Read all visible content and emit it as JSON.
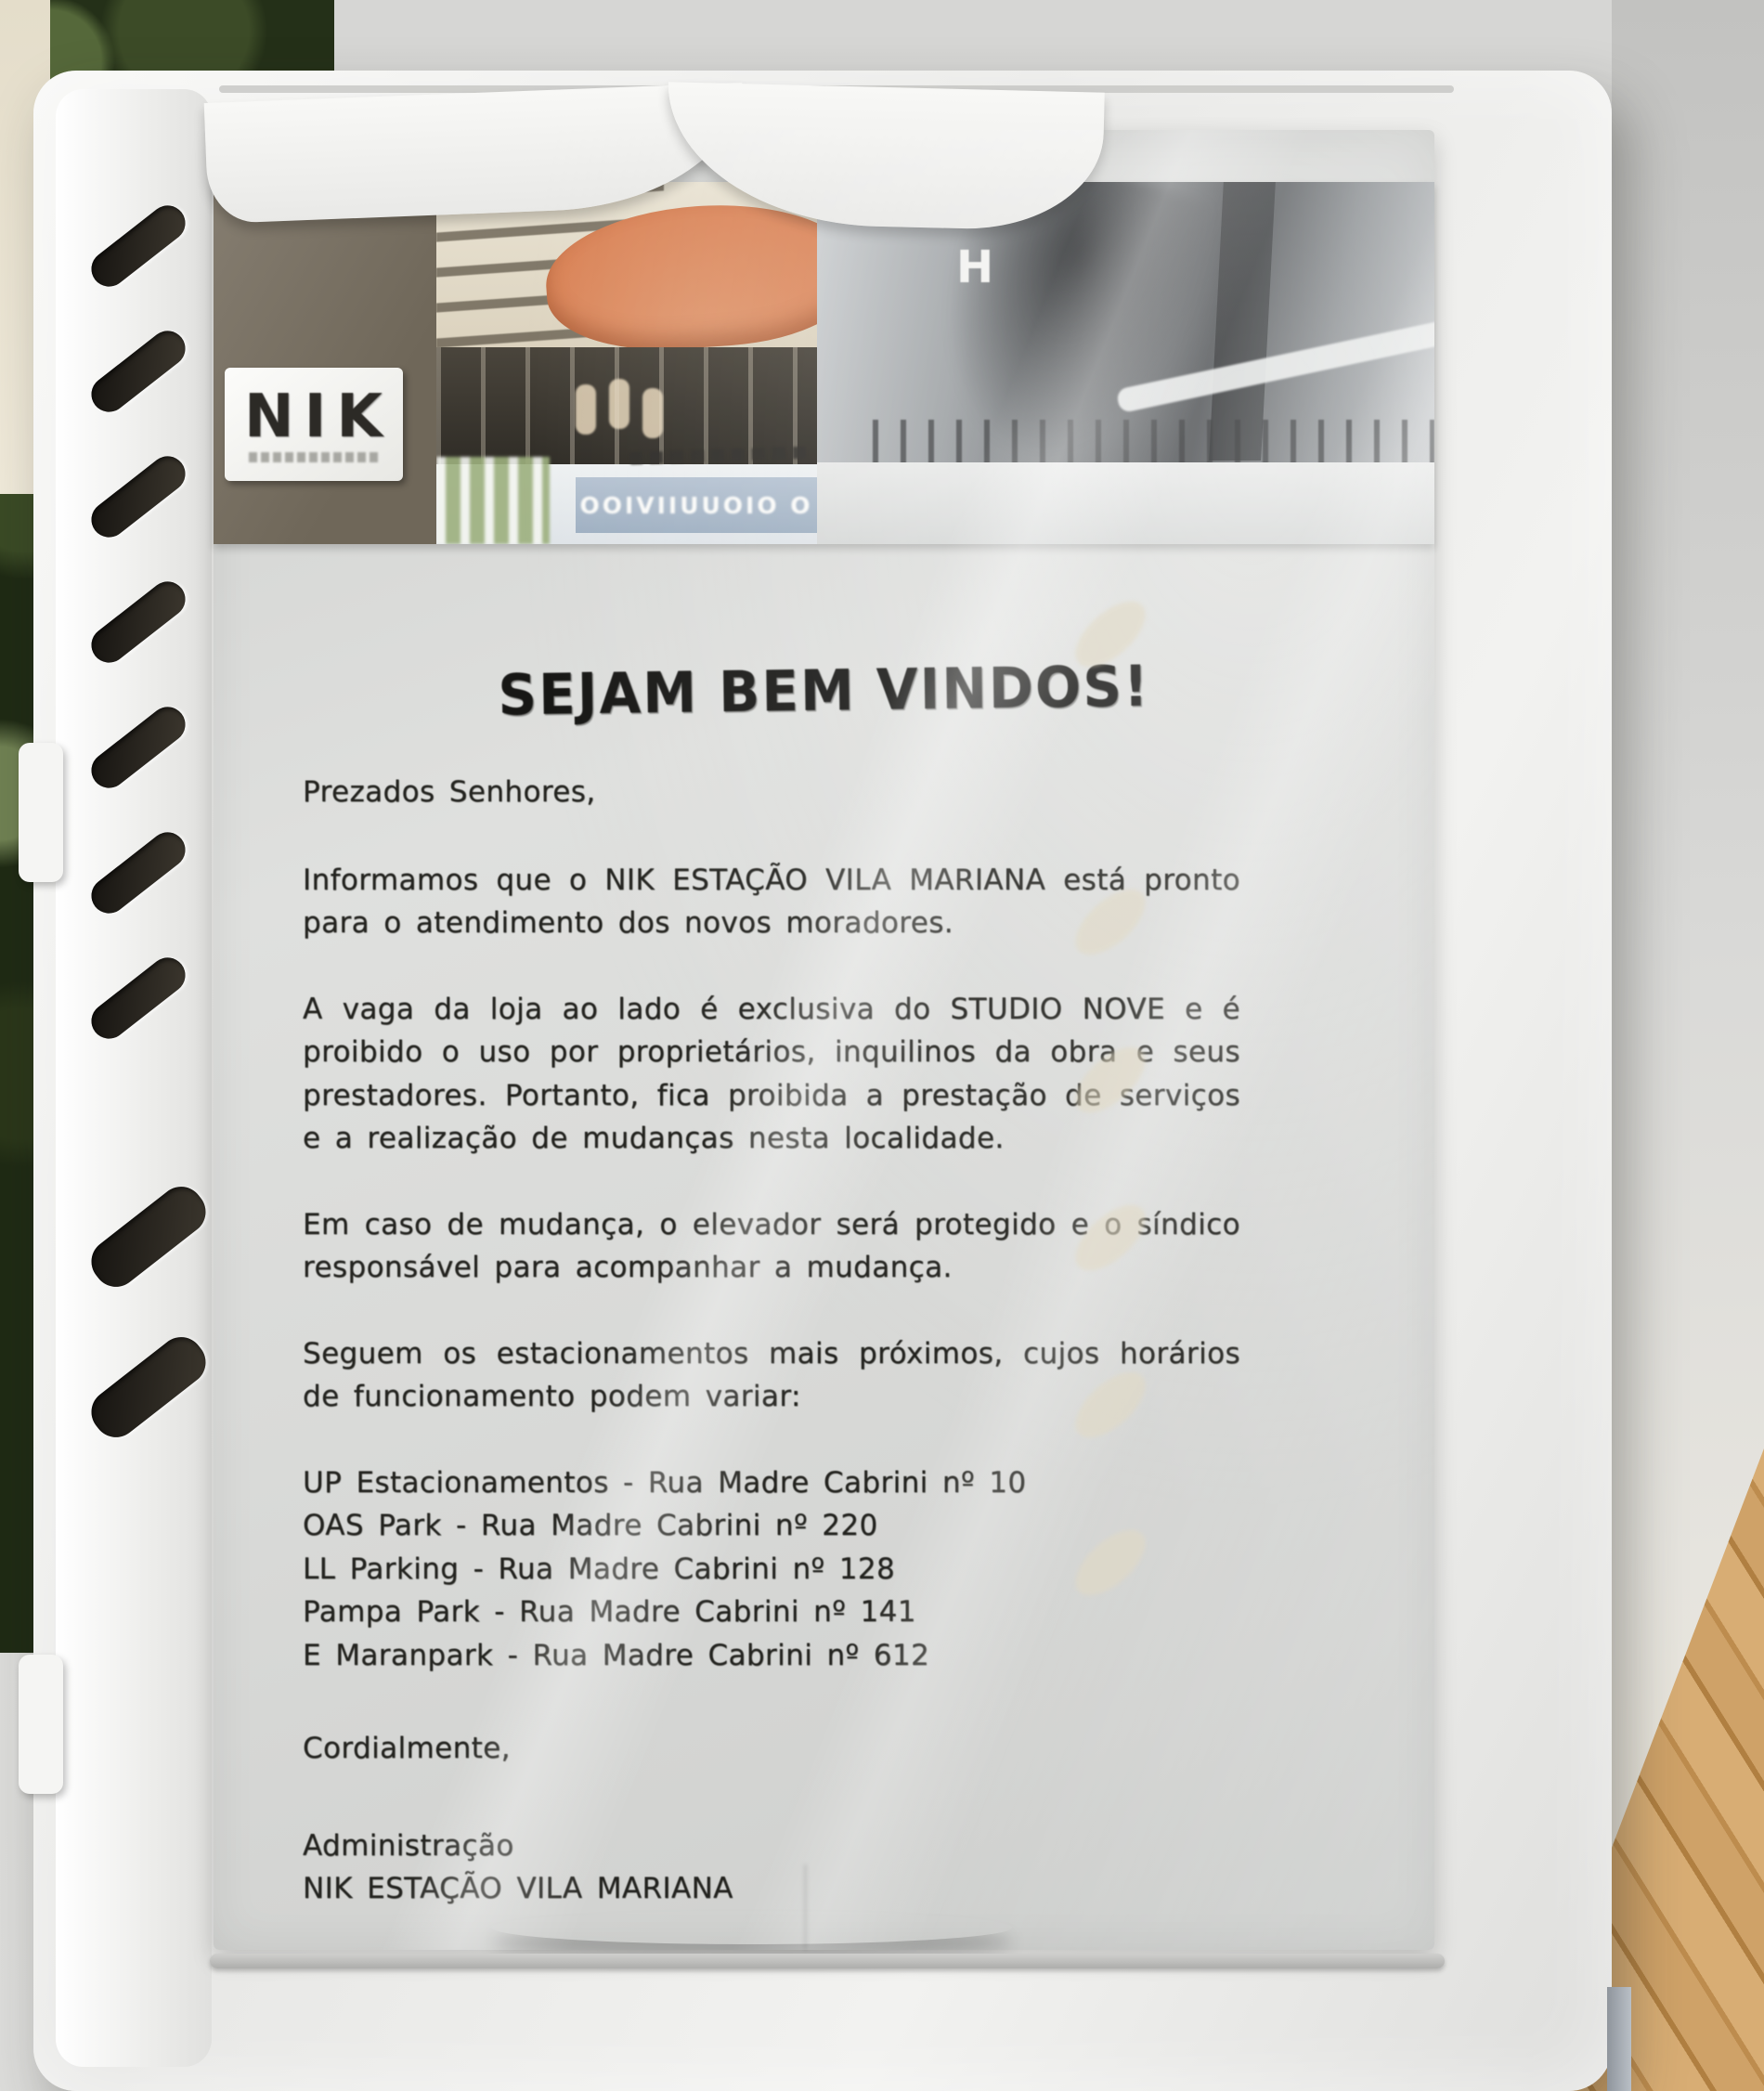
{
  "logo": {
    "name": "NIK"
  },
  "header_photos": {
    "h_letter": "H",
    "storefront_sign": "OOIVIIUUOIO O",
    "awning_color": "#d97f52"
  },
  "document": {
    "title": "SEJAM BEM VINDOS!",
    "greeting": "Prezados Senhores,",
    "paragraphs": [
      "Informamos que o NIK ESTAÇÃO VILA MARIANA está pronto para o atendimento dos novos moradores.",
      "A vaga da loja ao lado é exclusiva do STUDIO NOVE e é proibido o uso por proprietários, inquilinos da obra e seus prestadores. Portanto, fica proibida a prestação de serviços e a realização de mudanças nesta localidade.",
      "Em caso de mudança, o elevador será protegido e o síndico responsável para acompanhar a mudança.",
      "Seguem os estacionamentos mais próximos, cujos horários de funcionamento podem variar:"
    ],
    "parking_list": [
      "UP Estacionamentos - Rua Madre Cabrini nº 10",
      "OAS Park - Rua Madre Cabrini nº 220",
      "LL Parking - Rua Madre Cabrini nº 128",
      "Pampa Park - Rua Madre Cabrini nº 141",
      "E Maranpark - Rua Madre Cabrini nº 612"
    ],
    "closing": "Cordialmente,",
    "signature": [
      "Administração",
      "NIK ESTAÇÃO VILA MARIANA"
    ]
  },
  "colors": {
    "stand_white": "#f4f4f2",
    "paper": "#d9dad8",
    "ink": "#23231f",
    "logo_panel_brown": "#7a7264",
    "awning_orange": "#d97f52",
    "wood_floor": "#c9995c",
    "foliage_green": "#243018"
  }
}
